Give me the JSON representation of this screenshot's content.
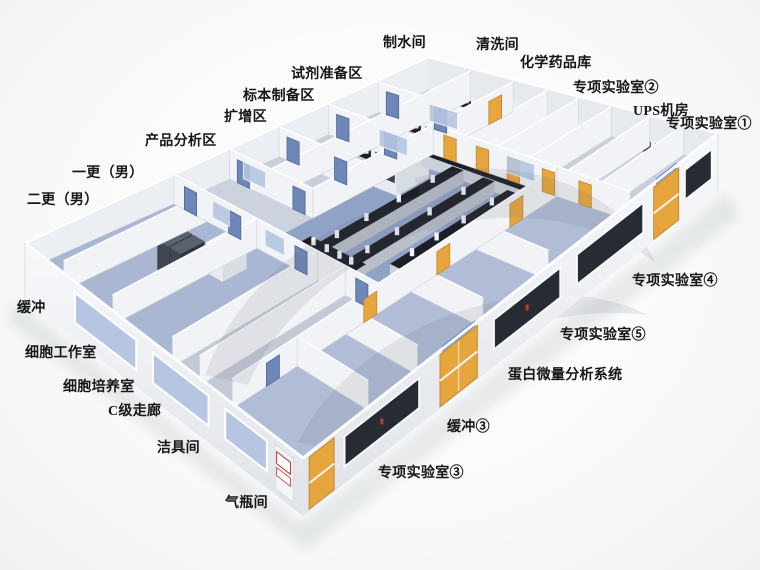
{
  "scene": {
    "description": "3D isometric rendering of a laboratory floor plan with labeled rooms",
    "background": "#f5f6f7",
    "colors": {
      "floor_blue": "#98a8c9",
      "floor_lab": "#90a2c6",
      "floor_light": "#cbd1dc",
      "wall": "#f2f3f6",
      "bench_dark": "#1c1f27",
      "door_yellow": "#e7a53e",
      "door_blue": "#6d88b8",
      "window_glass": "#b6c6e2",
      "window_dark": "#272b34",
      "sign_blue": "#4f7fc9",
      "sign_red": "#c0392b",
      "label_text": "#161616"
    }
  },
  "labels": [
    {
      "id": "water-production-room",
      "text": "制水间"
    },
    {
      "id": "cleaning-room",
      "text": "清洗间"
    },
    {
      "id": "chemical-storage",
      "text": "化学药品库"
    },
    {
      "id": "special-lab-2",
      "text": "专项实验室②"
    },
    {
      "id": "ups-room",
      "text": "UPS机房"
    },
    {
      "id": "special-lab-1",
      "text": "专项实验室①"
    },
    {
      "id": "reagent-prep-area",
      "text": "试剂准备区"
    },
    {
      "id": "specimen-prep-area",
      "text": "标本制备区"
    },
    {
      "id": "amplification-area",
      "text": "扩增区"
    },
    {
      "id": "product-analysis-area",
      "text": "产品分析区"
    },
    {
      "id": "change-room-1-male",
      "text": "一更（男）"
    },
    {
      "id": "change-room-2-male",
      "text": "二更（男）"
    },
    {
      "id": "buffer",
      "text": "缓冲"
    },
    {
      "id": "cell-work-room",
      "text": "细胞工作室"
    },
    {
      "id": "cell-culture-room",
      "text": "细胞培养室"
    },
    {
      "id": "class-c-corridor",
      "text": "C级走廊"
    },
    {
      "id": "cleaning-tool-room",
      "text": "洁具间"
    },
    {
      "id": "gas-cylinder-room",
      "text": "气瓶间"
    },
    {
      "id": "special-lab-4",
      "text": "专项实验室④"
    },
    {
      "id": "special-lab-5",
      "text": "专项实验室⑤"
    },
    {
      "id": "protein-micro-analysis-system",
      "text": "蛋白微量分析系统"
    },
    {
      "id": "buffer-3",
      "text": "缓冲③"
    },
    {
      "id": "special-lab-3",
      "text": "专项实验室③"
    }
  ]
}
